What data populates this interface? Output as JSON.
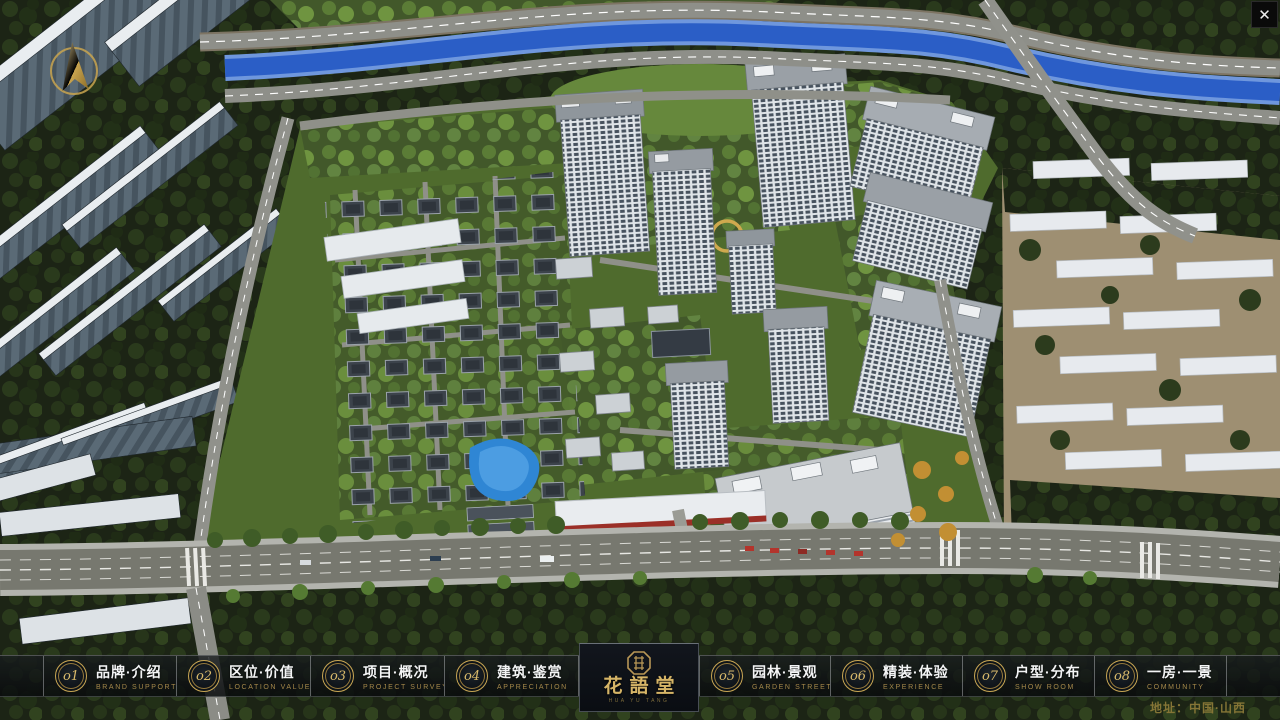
{
  "window": {
    "close_glyph": "✕"
  },
  "compass": {
    "icon": "north-arrow"
  },
  "menu": {
    "items": [
      {
        "number": "o1",
        "zh": "品牌·介绍",
        "en": "BRAND SUPPORT"
      },
      {
        "number": "o2",
        "zh": "区位·价值",
        "en": "LOCATION VALUE"
      },
      {
        "number": "o3",
        "zh": "项目·概况",
        "en": "PROJECT SURVEY"
      },
      {
        "number": "o4",
        "zh": "建筑·鉴赏",
        "en": "APPRECIATION"
      },
      {
        "number": "o5",
        "zh": "园林·景观",
        "en": "GARDEN STREET"
      },
      {
        "number": "o6",
        "zh": "精装·体验",
        "en": "EXPERIENCE"
      },
      {
        "number": "o7",
        "zh": "户型·分布",
        "en": "SHOW ROOM"
      },
      {
        "number": "o8",
        "zh": "一房·一景",
        "en": "COMMUNITY"
      }
    ]
  },
  "logo": {
    "title": "花語堂",
    "subtitle": "HUA YU TANG",
    "seal_icon": "seal-stamp"
  },
  "footer": {
    "address": "地址：中国·山西"
  },
  "colors": {
    "gold": "#d6b567",
    "bar_bg": "rgba(10,13,15,0.8)",
    "river": "#2b5ec6"
  }
}
